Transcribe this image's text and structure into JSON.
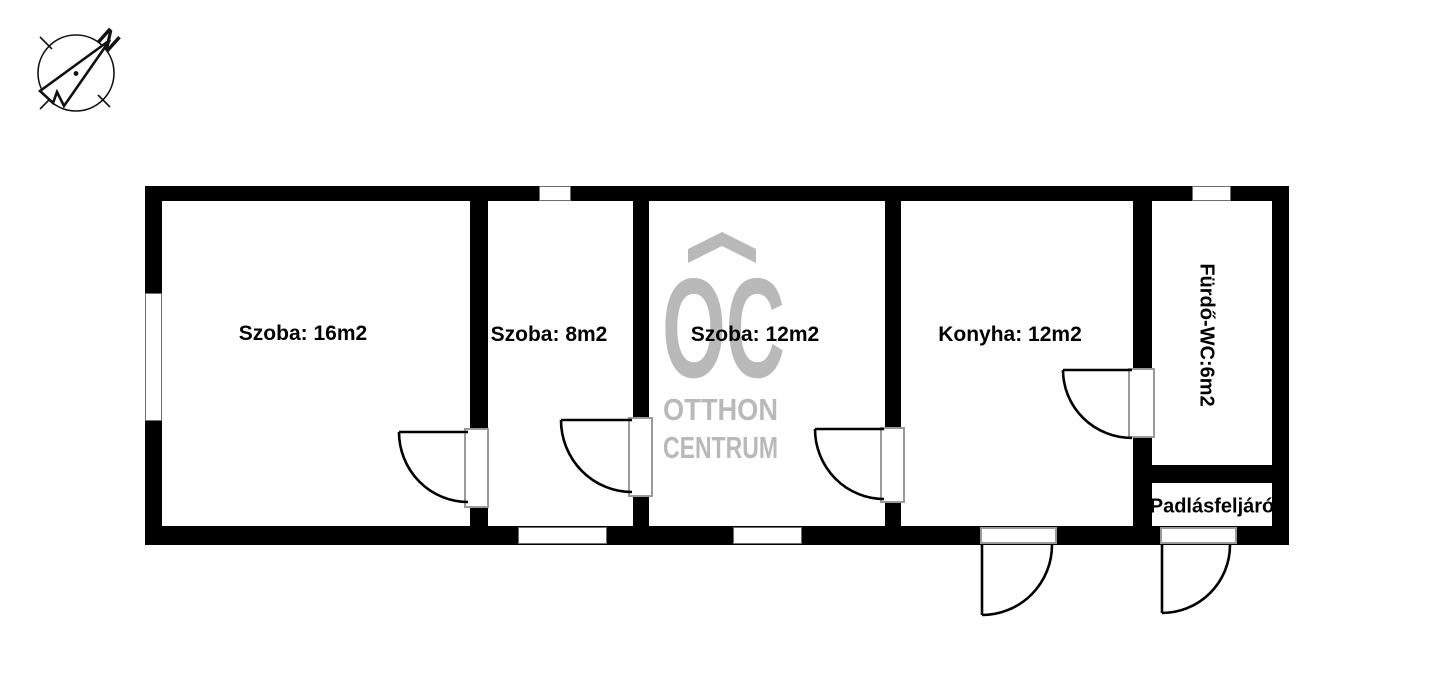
{
  "compass": {
    "north_label": "N"
  },
  "watermark": {
    "logo_text": "OC",
    "line1": "OTTHON",
    "line2": "CENTRUM",
    "color": "#b9b9b9"
  },
  "rooms": [
    {
      "label": "Szoba: 16m2"
    },
    {
      "label": "Szoba: 8m2"
    },
    {
      "label": "Szoba: 12m2"
    },
    {
      "label": "Konyha: 12m2"
    },
    {
      "label": "Fürdő-WC:6m2"
    },
    {
      "label": "Padlásfeljáró"
    }
  ],
  "colors": {
    "wall": "#000000",
    "background": "#ffffff",
    "watermark_gray": "#b9b9b9",
    "door_frame_gray": "#9a9a9a",
    "line_black": "#111111"
  }
}
